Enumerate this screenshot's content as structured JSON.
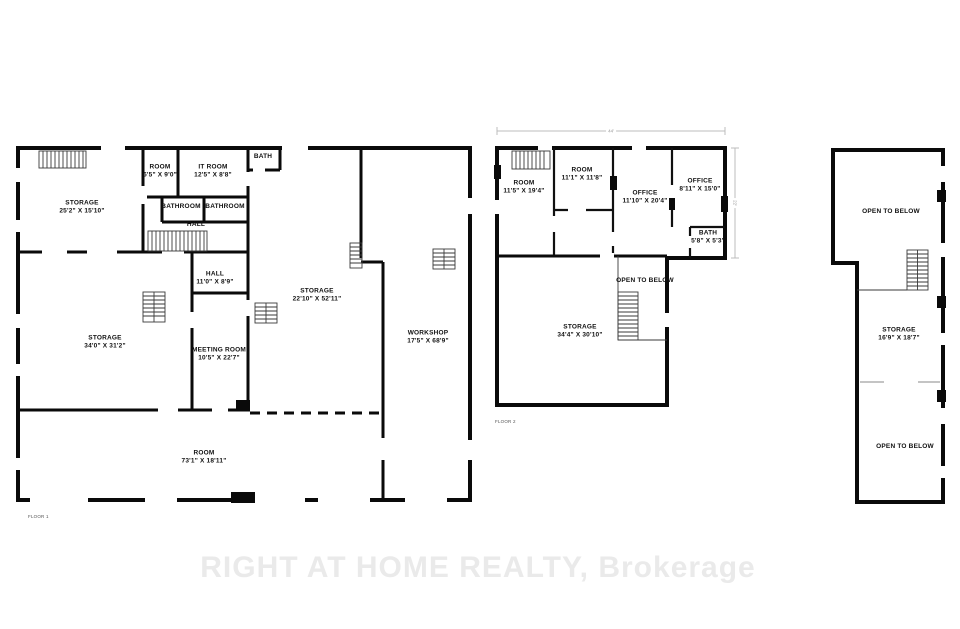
{
  "watermark": "RIGHT AT HOME REALTY, Brokerage",
  "colors": {
    "wall": "#0a0a0a",
    "watermark": "#eaeaea",
    "dimension_line": "#bcbcbc"
  },
  "floor1": {
    "caption": "FLOOR 1",
    "rooms": [
      {
        "name": "STORAGE",
        "dims": "25'2\" X 15'10\""
      },
      {
        "name": "ROOM",
        "dims": "6'5\" X 9'0\""
      },
      {
        "name": "IT ROOM",
        "dims": "12'5\" X 8'8\""
      },
      {
        "name": "BATH"
      },
      {
        "name": "BATHROOM"
      },
      {
        "name": "BATHROOM"
      },
      {
        "name": "HALL"
      },
      {
        "name": "HALL",
        "dims": "11'0\" X 8'9\""
      },
      {
        "name": "STORAGE",
        "dims": "34'0\" X 31'2\""
      },
      {
        "name": "MEETING ROOM",
        "dims": "10'5\" X 22'7\""
      },
      {
        "name": "STORAGE",
        "dims": "22'10\" X 52'11\""
      },
      {
        "name": "WORKSHOP",
        "dims": "17'5\" X 68'9\""
      },
      {
        "name": "ROOM",
        "dims": "73'1\" X 18'11\""
      }
    ]
  },
  "floor2": {
    "caption": "FLOOR 2",
    "dimension_width": "44'",
    "dimension_height": "22'",
    "rooms": [
      {
        "name": "ROOM",
        "dims": "11'5\" X 19'4\""
      },
      {
        "name": "ROOM",
        "dims": "11'1\" X 11'8\""
      },
      {
        "name": "OFFICE",
        "dims": "11'10\" X 20'4\""
      },
      {
        "name": "OFFICE",
        "dims": "8'11\" X 15'0\""
      },
      {
        "name": "BATH",
        "dims": "5'8\" X 5'3\""
      },
      {
        "name": "OPEN TO BELOW"
      },
      {
        "name": "STORAGE",
        "dims": "34'4\" X 30'10\""
      }
    ]
  },
  "floor3": {
    "rooms": [
      {
        "name": "OPEN TO BELOW"
      },
      {
        "name": "STORAGE",
        "dims": "16'9\" X 18'7\""
      },
      {
        "name": "OPEN TO BELOW"
      }
    ]
  }
}
